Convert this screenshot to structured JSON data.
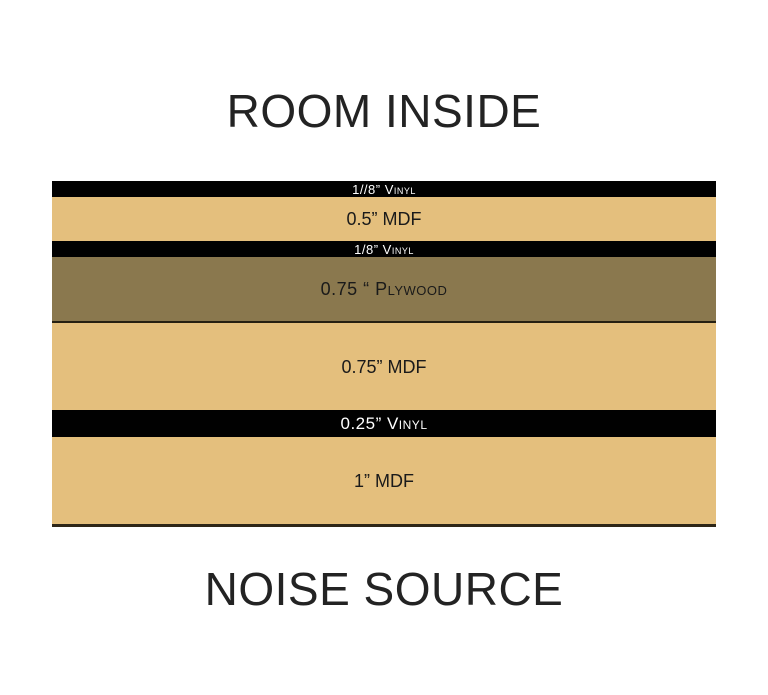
{
  "top_label": "ROOM INSIDE",
  "bottom_label": "NOISE SOURCE",
  "colors": {
    "vinyl": "#010101",
    "mdf": "#e4bf7d",
    "plywood": "#8a784e",
    "edge_line": "#2e2617",
    "vinyl_text": "#ffffff",
    "label_text": "#1a1a1a",
    "title_text": "#232323"
  },
  "layers": [
    {
      "label": "1//8” Vinyl",
      "material": "vinyl",
      "height": 16
    },
    {
      "label": "0.5” MDF",
      "material": "mdf",
      "height": 44
    },
    {
      "label": "1/8” Vinyl",
      "material": "vinyl",
      "height": 16
    },
    {
      "label": "0.75 “ Plywood",
      "material": "plywood",
      "height": 66
    },
    {
      "label": "0.75” MDF",
      "material": "mdf",
      "height": 87
    },
    {
      "label": "0.25” Vinyl",
      "material": "vinyl",
      "height": 27
    },
    {
      "label": "1” MDF",
      "material": "mdf",
      "height": 87
    }
  ]
}
